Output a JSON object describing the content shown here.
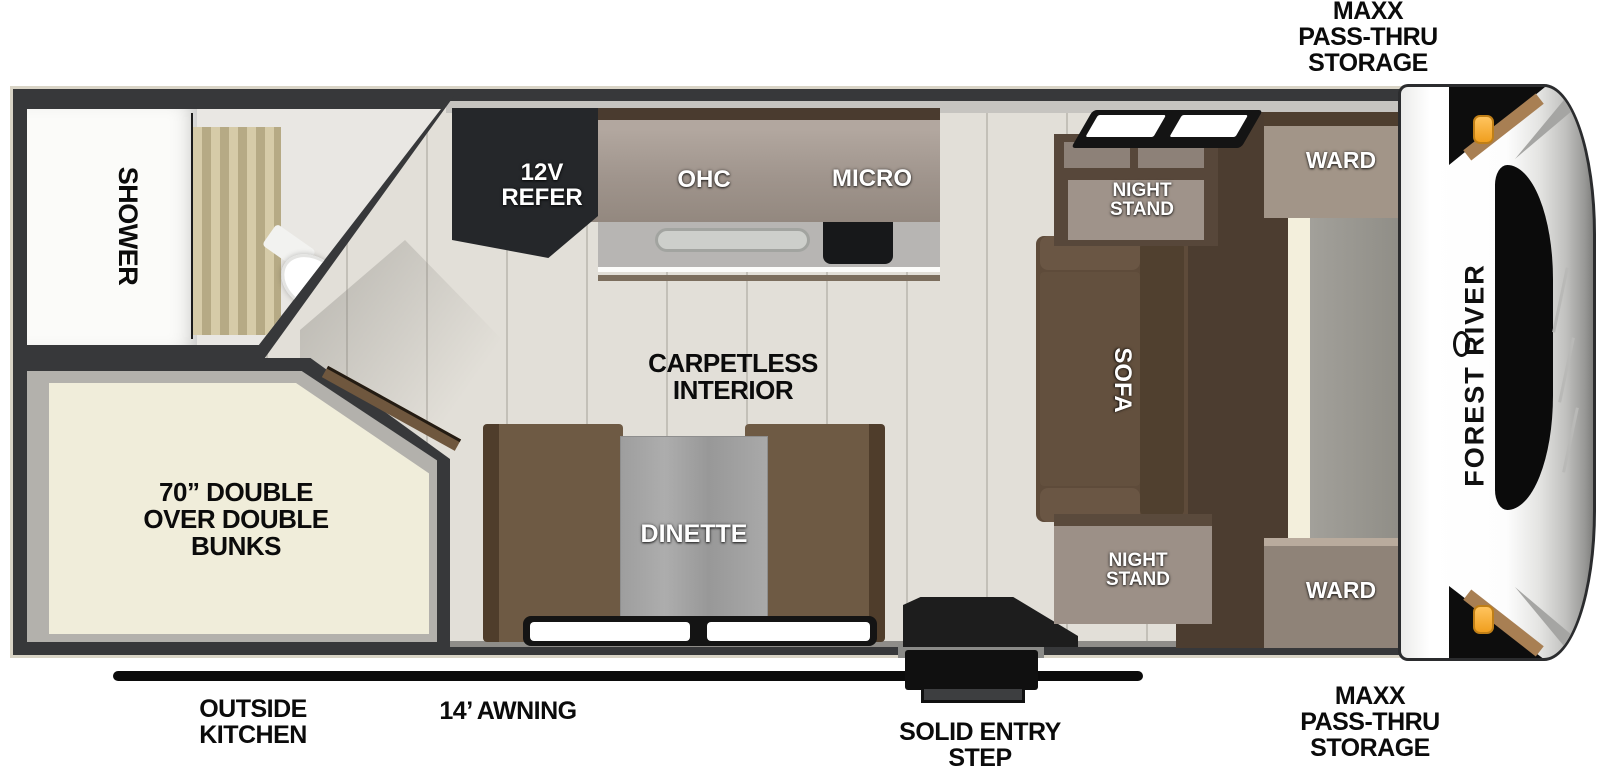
{
  "floorplan": {
    "brand": "FOREST RIVER",
    "labels": {
      "storage_top": "MAXX\nPASS-THRU\nSTORAGE",
      "storage_bottom": "MAXX\nPASS-THRU\nSTORAGE",
      "outside_kitchen": "OUTSIDE\nKITCHEN",
      "awning": "14’ AWNING",
      "entry_step": "SOLID ENTRY\nSTEP",
      "carpetless": "CARPETLESS\nINTERIOR",
      "bunks": "70” DOUBLE\nOVER DOUBLE\nBUNKS",
      "shower": "SHOWER",
      "refer": "12V\nREFER",
      "ohc": "OHC",
      "micro": "MICRO",
      "dinette": "DINETTE",
      "sofa": "SOFA",
      "nightstand_top": "NIGHT\nSTAND",
      "nightstand_bottom": "NIGHT\nSTAND",
      "ward_top": "WARD",
      "ward_bottom": "WARD"
    },
    "colors": {
      "wall": "#37383a",
      "trim": "#d9d4c6",
      "floor_wood": "#e2dfd8",
      "cabinet_face": "#a0958d",
      "cabinet_dark": "#4a3b2f",
      "refer_black": "#25272a",
      "bench_brown": "#6e5a44",
      "table_gray": "#a6a6a6",
      "sofa_brown": "#5e4b3a",
      "bed_cream": "#f0edda",
      "curtain_tan": "#c6ba96",
      "storage_gray": "#9a9892",
      "marker_orange": "#f5a623",
      "accent_tan": "#a87f53",
      "label_black": "#0b0b0b"
    }
  }
}
